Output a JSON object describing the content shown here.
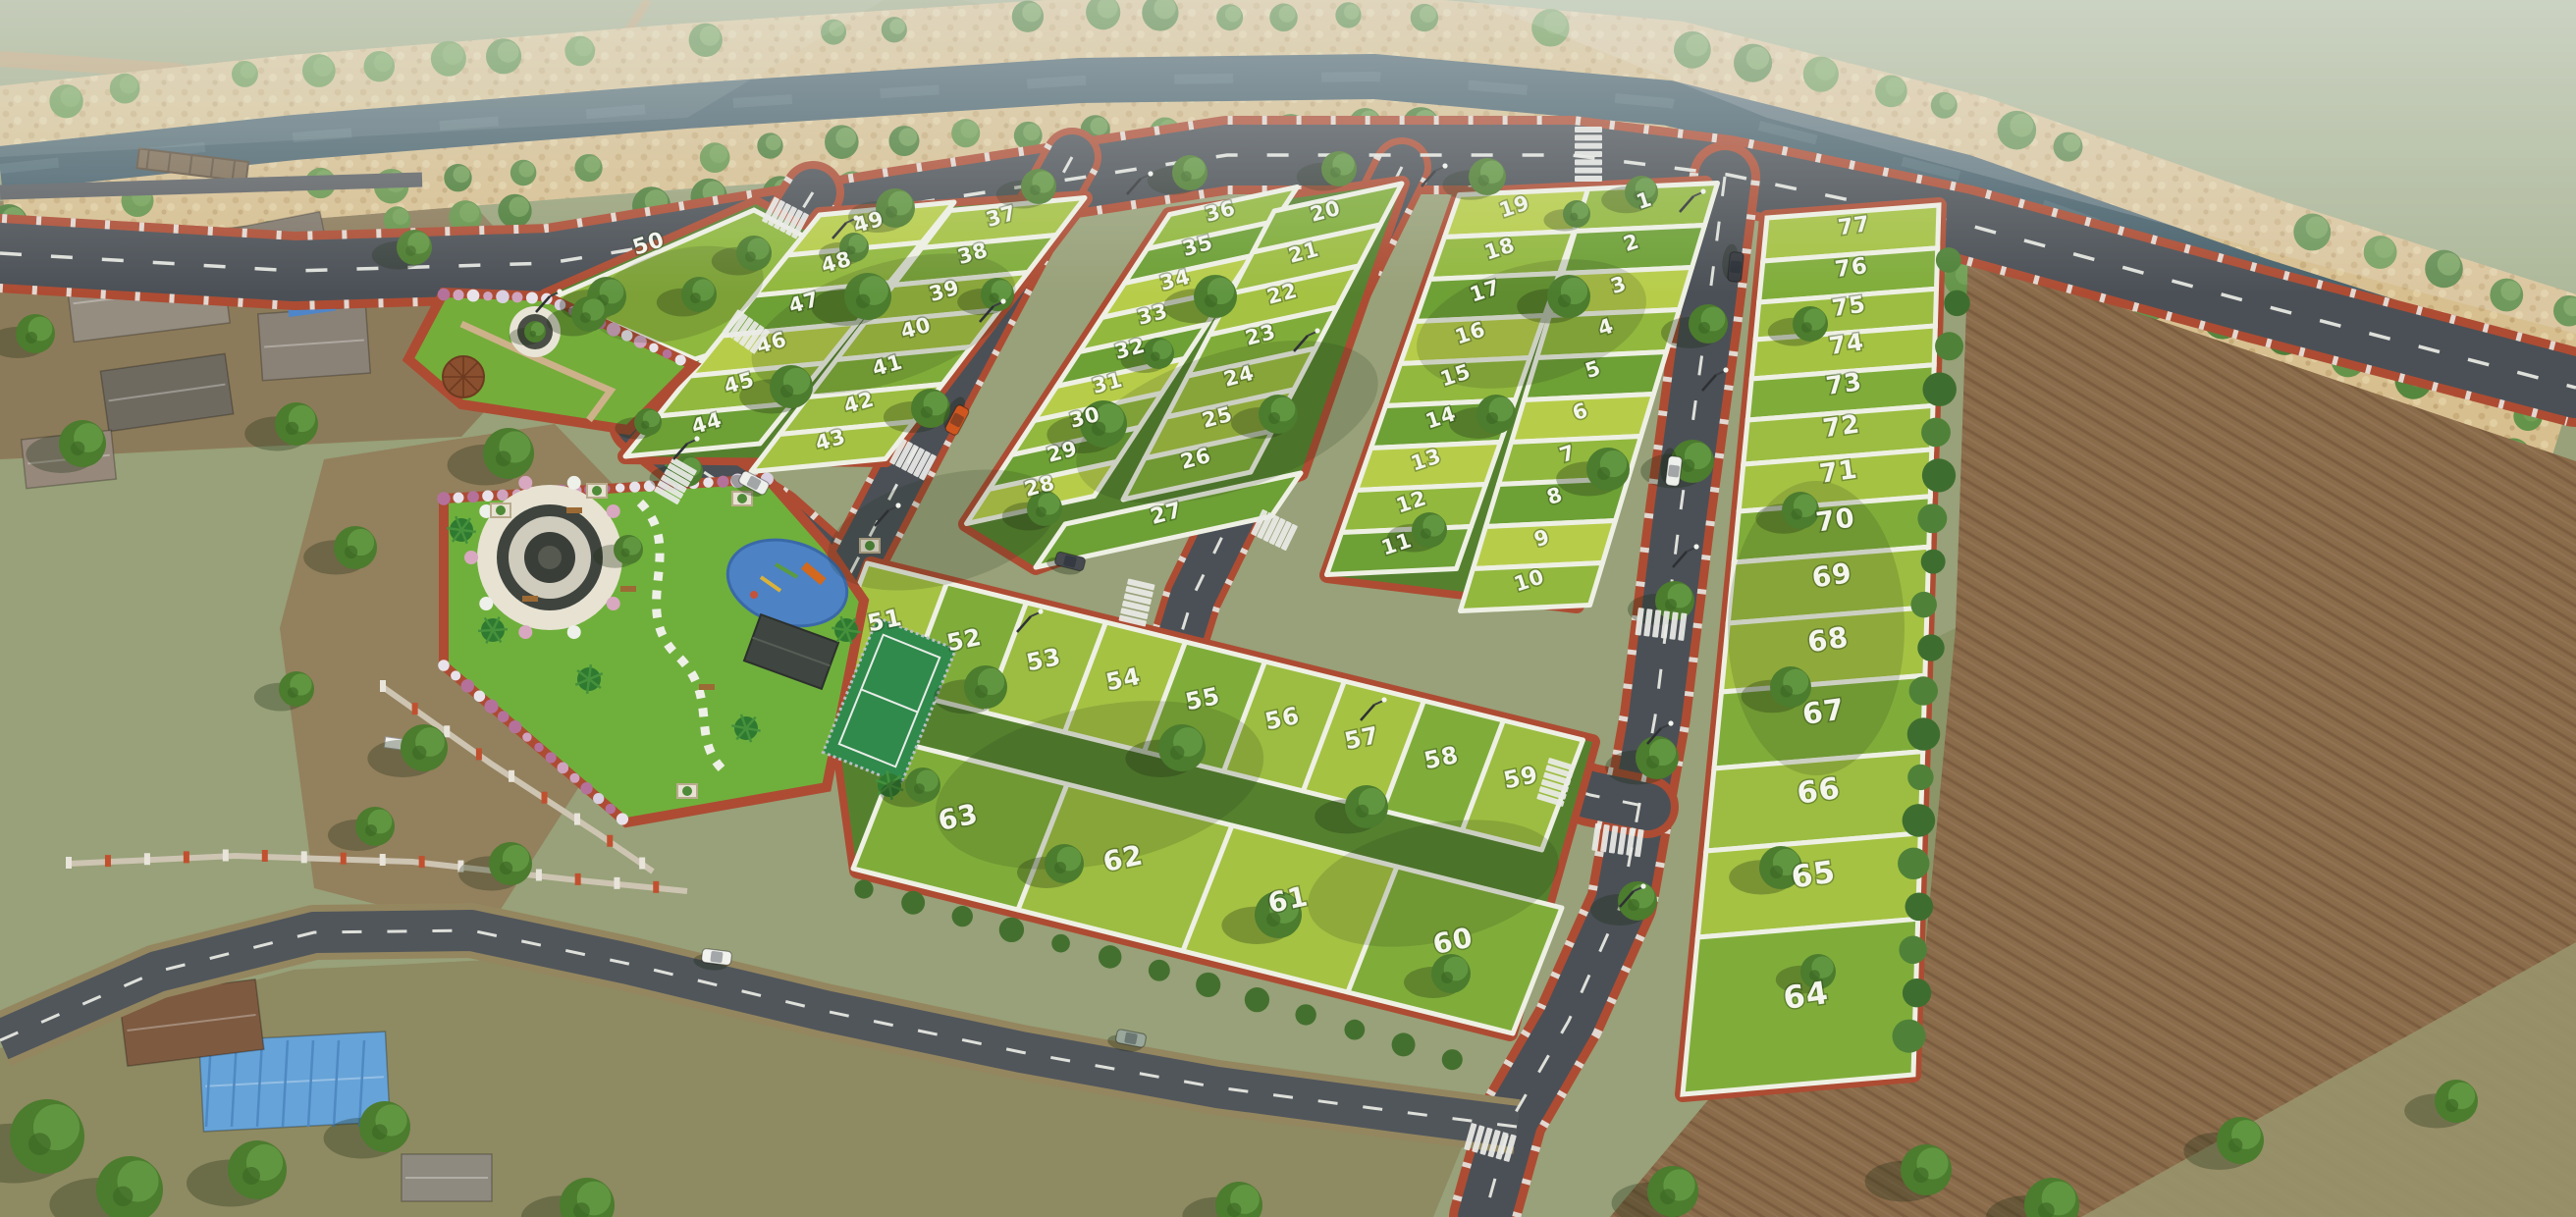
{
  "plots": {
    "west_triangle": [
      "50"
    ],
    "west_block": {
      "col_outer": [
        "49",
        "48",
        "47",
        "46",
        "45",
        "44"
      ],
      "col_inner": [
        "37",
        "38",
        "39",
        "40",
        "41",
        "42",
        "43"
      ]
    },
    "middle_block": {
      "col_west": [
        "36",
        "35",
        "34",
        "33",
        "32",
        "31",
        "30",
        "29",
        "28"
      ],
      "corner_south": [
        "27"
      ],
      "col_east": [
        "20",
        "21",
        "22",
        "23",
        "24",
        "25",
        "26"
      ]
    },
    "east_block": {
      "col_west": [
        "19",
        "18",
        "17",
        "16",
        "15",
        "14",
        "13",
        "12",
        "11"
      ],
      "col_east": [
        "1",
        "2",
        "3",
        "4",
        "5",
        "6",
        "7",
        "8",
        "9",
        "10"
      ]
    },
    "far_east_column": [
      "77",
      "76",
      "75",
      "74",
      "73",
      "72",
      "71",
      "70",
      "69",
      "68",
      "67",
      "66",
      "65",
      "64"
    ],
    "south_block": {
      "row_north": [
        "51",
        "52",
        "53",
        "54",
        "55",
        "56",
        "57",
        "58",
        "59"
      ],
      "row_south": [
        "63",
        "62",
        "61",
        "60"
      ]
    }
  },
  "colors": {
    "plot_green_light": "#b7cd4a",
    "plot_green": "#92b83e",
    "plot_green_dark": "#6da035",
    "road_asphalt": "#4b5056",
    "kerb_red": "#ad4c33",
    "canal_water": "#48616c",
    "bank_sand": "#d7bf90",
    "farmland_brown": "#8a6b4a",
    "park_turf": "#6fb03c",
    "playground_blue": "#4d82c4"
  }
}
